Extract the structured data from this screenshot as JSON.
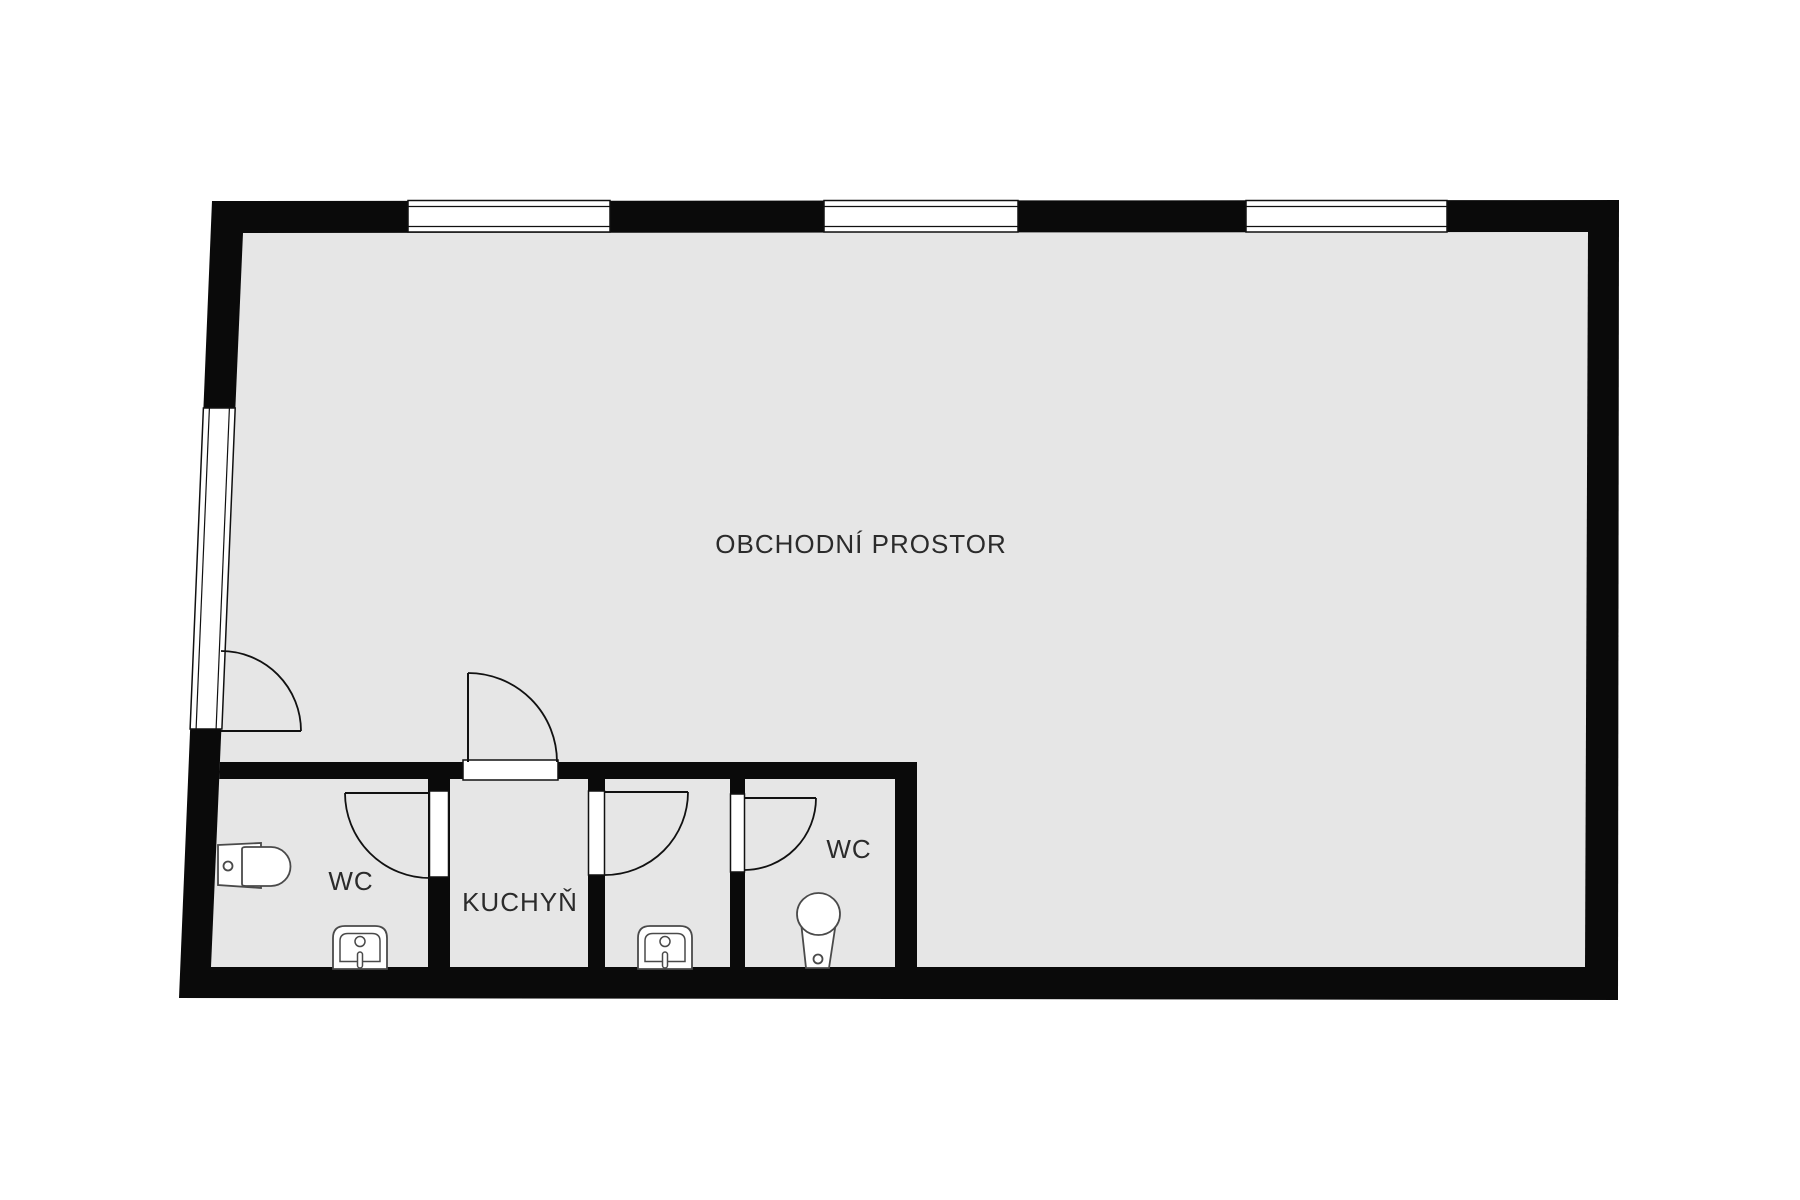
{
  "canvas": {
    "width": 1800,
    "height": 1200,
    "background": "#ffffff",
    "floor_color": "#e6e6e6",
    "wall_color": "#0a0a0a",
    "line_color": "#111111",
    "fixture_stroke": "#4a4a4a",
    "text_color": "#2b2b2b"
  },
  "rooms": {
    "main": {
      "label": "OBCHODNÍ PROSTOR",
      "label_x": 861,
      "label_y": 553
    },
    "wc_left": {
      "label": "WC",
      "label_x": 351,
      "label_y": 890
    },
    "kitchen": {
      "label": "KUCHYŇ",
      "label_x": 520,
      "label_y": 911
    },
    "wc_right": {
      "label": "WC",
      "label_x": 849,
      "label_y": 858
    }
  },
  "geometry": {
    "outline": {
      "outer": [
        [
          212,
          201
        ],
        [
          1619,
          200
        ],
        [
          1618,
          1000
        ],
        [
          179,
          998
        ]
      ],
      "inner": [
        [
          243,
          233
        ],
        [
          1588,
          232
        ],
        [
          1585,
          967
        ],
        [
          211,
          967
        ]
      ]
    },
    "partitions": [
      {
        "name": "partition-top",
        "points": [
          [
            219.9,
            762
          ],
          [
            917,
            762
          ],
          [
            917,
            779
          ],
          [
            219.2,
            779
          ]
        ]
      },
      {
        "name": "partition-wcleft-kitchen",
        "rect": [
          428,
          779,
          22,
          189
        ]
      },
      {
        "name": "partition-kitchen-room",
        "rect": [
          588,
          779,
          17,
          189
        ]
      },
      {
        "name": "partition-room-wcright",
        "rect": [
          730,
          779,
          15,
          189
        ]
      },
      {
        "name": "block-end-wall",
        "rect": [
          895,
          779,
          22,
          189
        ]
      }
    ],
    "windows_top": {
      "band_y": 200.5,
      "band_h": 31.5,
      "pane_line_y1": 206.5,
      "pane_line_y2": 226.5,
      "items": [
        {
          "name": "window-top-1",
          "x": 408,
          "w": 202
        },
        {
          "name": "window-top-2",
          "x": 824,
          "w": 194
        },
        {
          "name": "window-top-3",
          "x": 1246,
          "w": 201
        }
      ]
    },
    "window_left": {
      "name": "window-left",
      "points": [
        [
          203.4,
          408
        ],
        [
          235.2,
          408
        ],
        [
          221.9,
          729
        ],
        [
          190.1,
          729
        ]
      ],
      "pane_lines": [
        [
          [
            209.4,
            408
          ],
          [
            196.1,
            729
          ]
        ],
        [
          [
            229.4,
            408
          ],
          [
            216.1,
            729
          ]
        ]
      ]
    },
    "doors": [
      {
        "name": "entrance-door",
        "leaf": [
          [
            221,
            731
          ],
          [
            301,
            731
          ]
        ],
        "arc": "M 221,651 A 80,80 0 0 1 301,731"
      },
      {
        "name": "kitchen-door",
        "jamb": [
          463,
          760,
          95,
          20
        ],
        "leaf": [
          [
            468,
            673
          ],
          [
            468,
            762
          ]
        ],
        "arc": "M 468,673 A 89,89 0 0 1 557,762"
      },
      {
        "name": "wc-left-door",
        "jamb": [
          429.5,
          791,
          19,
          86
        ],
        "leaf": [
          [
            345,
            793
          ],
          [
            430,
            793
          ]
        ],
        "arc": "M 345,793 A 85,85 0 0 0 430,878"
      },
      {
        "name": "middle-room-door",
        "jamb": [
          588.5,
          791,
          16,
          84
        ],
        "leaf": [
          [
            605,
            792
          ],
          [
            688,
            792
          ]
        ],
        "arc": "M 688,792 A 83,83 0 0 1 605,875"
      },
      {
        "name": "wc-right-door",
        "jamb": [
          730.5,
          794,
          14,
          78
        ],
        "leaf": [
          [
            745,
            798
          ],
          [
            816,
            798
          ]
        ],
        "arc": "M 816,798 A 72,72 0 0 1 745,870"
      }
    ],
    "toilet_left": {
      "name": "toilet-wc-left",
      "tank": [
        [
          218,
          845
        ],
        [
          261,
          843
        ],
        [
          261,
          888
        ],
        [
          218,
          885
        ]
      ],
      "bowl": "M 242,849 Q 242,847 246,847 L 271,847 A 19.5,19.5 0 0 1 271,886 L 246,886 Q 242,886 242,884 Z",
      "flush": [
        228,
        866,
        4.5
      ]
    },
    "toilet_right": {
      "name": "toilet-wc-right",
      "body": [
        [
          801,
          922
        ],
        [
          836,
          922
        ],
        [
          829,
          968
        ],
        [
          806,
          968
        ]
      ],
      "bowl": [
        818.5,
        914,
        21.5,
        21
      ],
      "flush": [
        818,
        959,
        4.5
      ]
    },
    "sinks": [
      {
        "name": "sink-wc-left",
        "outer": "M 333,969 L 333,938 Q 333,926 345,926 L 375,926 Q 387,926 387,938 L 387,969 Z",
        "inner": "M 340,961.5 L 340,941 Q 340,933.5 348,933.5 L 372,933.5 Q 380,933.5 380,941 L 380,961.5 Z",
        "faucet": [
          360,
          941.5,
          5
        ],
        "drain": [
          357.5,
          952,
          5,
          16
        ]
      },
      {
        "name": "sink-middle-room",
        "outer": "M 638,969 L 638,938 Q 638,926 650,926 L 680,926 Q 692,926 692,938 L 692,969 Z",
        "inner": "M 645,961.5 L 645,941 Q 645,933.5 653,933.5 L 677,933.5 Q 685,933.5 685,941 L 685,961.5 Z",
        "faucet": [
          665,
          941.5,
          5
        ],
        "drain": [
          662.5,
          952,
          5,
          16
        ]
      }
    ]
  }
}
